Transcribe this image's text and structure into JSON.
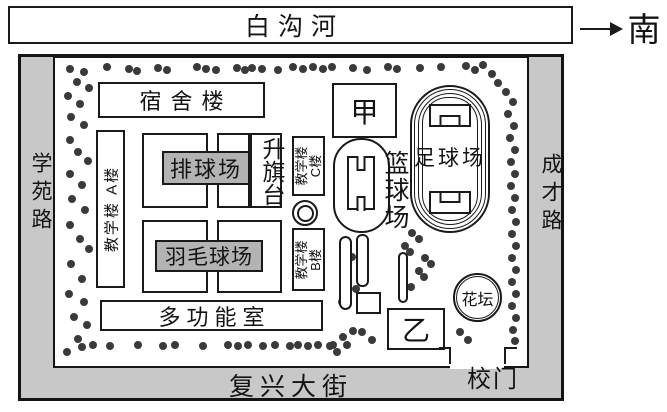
{
  "map": {
    "river": {
      "label": "白沟河"
    },
    "direction": {
      "label": "南"
    },
    "roads": {
      "left": "学苑路",
      "right": "成才路",
      "bottom": "复兴大街"
    },
    "buildings": {
      "dormitory": "宿舍楼",
      "teaching_a": "教学楼 A楼",
      "teaching_b_line1": "教学楼",
      "teaching_b_line2": "B楼",
      "teaching_c_line1": "教学楼",
      "teaching_c_line2": "C楼",
      "multifunction": "多功能室",
      "jia": "甲",
      "yi": "乙"
    },
    "facilities": {
      "volleyball": "排球场",
      "badminton": "羽毛球场",
      "flag_platform": "升旗台",
      "basketball": "篮球场",
      "football": "足球场",
      "flowerbed": "花坛",
      "gate": "校门"
    }
  },
  "colors": {
    "road_fill": "#c8c8c8",
    "court_label_fill": "#b3b3b3",
    "tree": "#3a3a3a",
    "ink": "#1a1a1a"
  },
  "trees": [
    [
      70,
      69
    ],
    [
      84,
      72
    ],
    [
      107,
      67
    ],
    [
      129,
      69
    ],
    [
      137,
      71
    ],
    [
      158,
      68
    ],
    [
      167,
      70
    ],
    [
      197,
      67
    ],
    [
      206,
      69
    ],
    [
      216,
      70
    ],
    [
      237,
      68
    ],
    [
      245,
      70
    ],
    [
      252,
      68
    ],
    [
      262,
      69
    ],
    [
      278,
      70
    ],
    [
      293,
      67
    ],
    [
      303,
      69
    ],
    [
      313,
      67
    ],
    [
      323,
      69
    ],
    [
      332,
      67
    ],
    [
      353,
      68
    ],
    [
      367,
      70
    ],
    [
      388,
      67
    ],
    [
      397,
      69
    ],
    [
      420,
      68
    ],
    [
      441,
      67
    ],
    [
      466,
      66
    ],
    [
      475,
      70
    ],
    [
      483,
      65
    ],
    [
      492,
      74
    ],
    [
      498,
      83
    ],
    [
      77,
      82
    ],
    [
      89,
      88
    ],
    [
      68,
      96
    ],
    [
      80,
      104
    ],
    [
      71,
      117
    ],
    [
      84,
      125
    ],
    [
      70,
      140
    ],
    [
      78,
      152
    ],
    [
      88,
      161
    ],
    [
      70,
      174
    ],
    [
      82,
      185
    ],
    [
      72,
      199
    ],
    [
      85,
      210
    ],
    [
      70,
      225
    ],
    [
      80,
      239
    ],
    [
      89,
      249
    ],
    [
      71,
      264
    ],
    [
      82,
      279
    ],
    [
      69,
      294
    ],
    [
      84,
      302
    ],
    [
      74,
      317
    ],
    [
      87,
      325
    ],
    [
      78,
      339
    ],
    [
      67,
      352
    ],
    [
      506,
      92
    ],
    [
      513,
      102
    ],
    [
      508,
      114
    ],
    [
      514,
      126
    ],
    [
      510,
      138
    ],
    [
      515,
      150
    ],
    [
      511,
      162
    ],
    [
      515,
      174
    ],
    [
      511,
      186
    ],
    [
      515,
      198
    ],
    [
      512,
      210
    ],
    [
      516,
      222
    ],
    [
      512,
      234
    ],
    [
      516,
      246
    ],
    [
      512,
      258
    ],
    [
      516,
      270
    ],
    [
      512,
      282
    ],
    [
      516,
      294
    ],
    [
      512,
      306
    ],
    [
      516,
      318
    ],
    [
      513,
      330
    ],
    [
      515,
      341
    ],
    [
      82,
      347
    ],
    [
      93,
      345
    ],
    [
      110,
      346
    ],
    [
      138,
      345
    ],
    [
      163,
      346
    ],
    [
      175,
      345
    ],
    [
      203,
      346
    ],
    [
      228,
      345
    ],
    [
      238,
      346
    ],
    [
      248,
      345
    ],
    [
      263,
      346
    ],
    [
      275,
      345
    ],
    [
      290,
      346
    ],
    [
      298,
      345
    ],
    [
      308,
      346
    ],
    [
      318,
      345
    ],
    [
      330,
      346
    ],
    [
      337,
      352
    ],
    [
      347,
      345
    ],
    [
      412,
      233
    ],
    [
      419,
      239
    ],
    [
      405,
      246
    ],
    [
      410,
      252
    ],
    [
      425,
      258
    ],
    [
      431,
      264
    ],
    [
      419,
      271
    ],
    [
      424,
      277
    ],
    [
      411,
      287
    ],
    [
      404,
      296
    ],
    [
      352,
      257
    ],
    [
      362,
      267
    ],
    [
      346,
      278
    ],
    [
      356,
      289
    ],
    [
      342,
      302
    ],
    [
      362,
      332
    ],
    [
      372,
      340
    ],
    [
      333,
      345
    ],
    [
      343,
      337
    ],
    [
      353,
      331
    ],
    [
      460,
      332
    ],
    [
      468,
      340
    ]
  ]
}
